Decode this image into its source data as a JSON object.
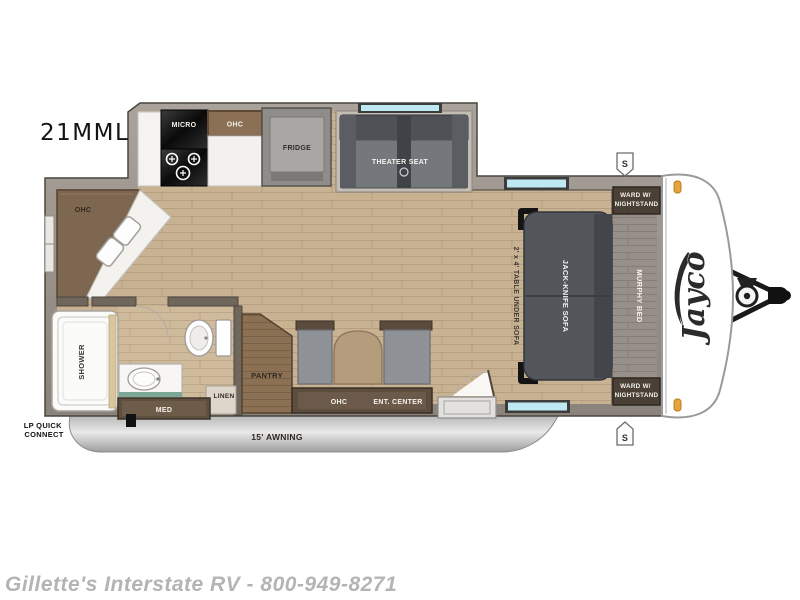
{
  "title": {
    "model": "21MML"
  },
  "brand": {
    "logo": "Jayco"
  },
  "kitchen": {
    "micro": "MICRO",
    "ohc": "OHC",
    "fridge": "FRIDGE"
  },
  "galley_corner": {
    "ohc": "OHC"
  },
  "living": {
    "theater_seat": "THEATER SEAT",
    "jack_knife_sofa": "JACK-KNIFE SOFA",
    "table_note": "2' x 4' TABLE UNDER SOFA"
  },
  "bedroom": {
    "murphy_bed": "MURPHY BED",
    "ward_top_line1": "WARD W/",
    "ward_top_line2": "NIGHTSTAND",
    "ward_bottom_line1": "WARD W/",
    "ward_bottom_line2": "NIGHTSTAND"
  },
  "bath": {
    "shower": "SHOWER",
    "med": "MED",
    "linen": "LINEN"
  },
  "storage": {
    "pantry": "PANTRY",
    "ohc": "OHC",
    "ent_center": "ENT. CENTER"
  },
  "exterior": {
    "awning": "15' AWNING",
    "lp_line1": "LP QUICK",
    "lp_line2": "CONNECT",
    "speaker_top": "S",
    "speaker_bottom": "S"
  },
  "footer": {
    "dealer": "Gillette's Interstate RV - 800-949-8271"
  },
  "palette": {
    "floor": "#c8b292",
    "wall": "#9a938b",
    "cabinet_dark": "#5d4d3e",
    "cabinet_brown": "#7d6750",
    "sofa_gray": "#53575c",
    "window_blue": "#bfe9f2",
    "awning_gray": "#d9d9d9",
    "marker_orange": "#e6a23c"
  }
}
